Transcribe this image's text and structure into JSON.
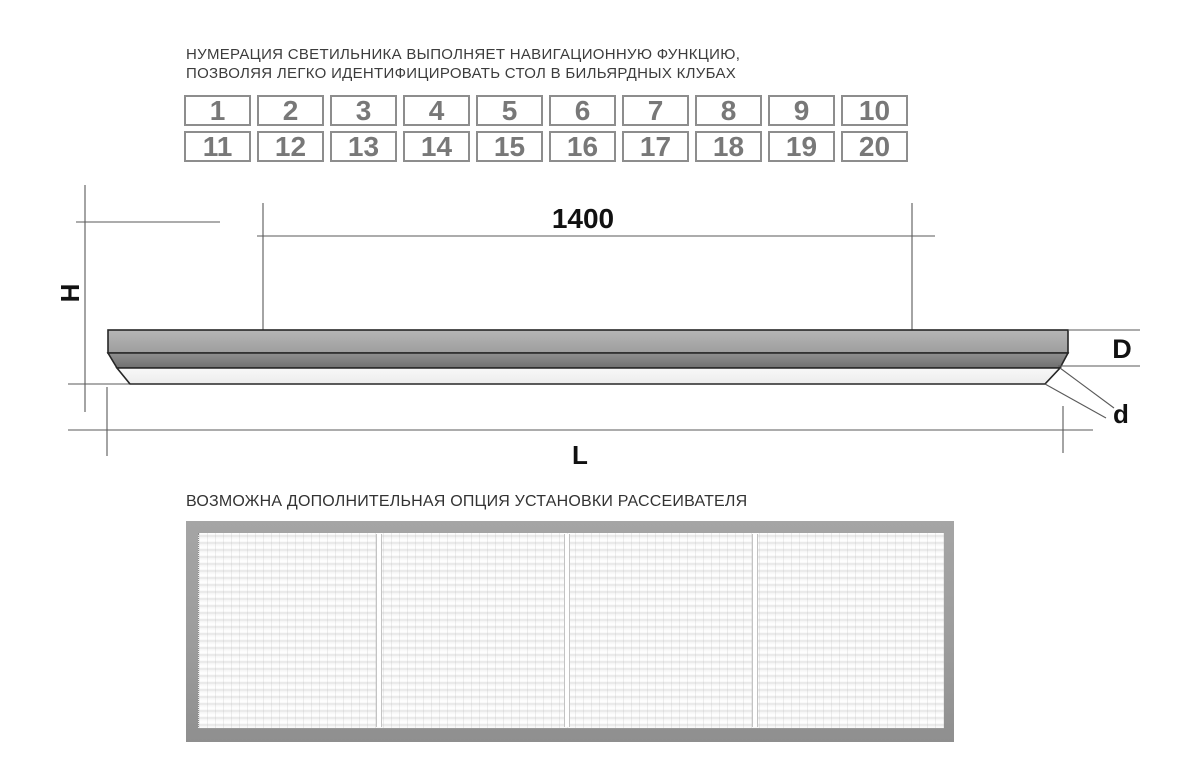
{
  "headline": {
    "line1": "НУМЕРАЦИЯ СВЕТИЛЬНИКА ВЫПОЛНЯЕТ НАВИГАЦИОННУЮ ФУНКЦИЮ,",
    "line2": "ПОЗВОЛЯЯ ЛЕГКО ИДЕНТИФИЦИРОВАТЬ СТОЛ В БИЛЬЯРДНЫХ КЛУБАХ"
  },
  "number_grid": {
    "rows": [
      [
        "1",
        "2",
        "3",
        "4",
        "5",
        "6",
        "7",
        "8",
        "9",
        "10"
      ],
      [
        "11",
        "12",
        "13",
        "14",
        "15",
        "16",
        "17",
        "18",
        "19",
        "20"
      ]
    ]
  },
  "diagram": {
    "dim_span": "1400",
    "dim_height": "H",
    "dim_body": "D",
    "dim_edge": "d",
    "dim_length": "L"
  },
  "caption": "ВОЗМОЖНА ДОПОЛНИТЕЛЬНАЯ ОПЦИЯ УСТАНОВКИ РАССЕИВАТЕЛЯ",
  "colors": {
    "text": "#3c3c3c",
    "drawing_line": "#5a5a5a",
    "fixture_outline": "#262626",
    "fixture_top": "#a9a9a9",
    "fixture_mid": "#828282",
    "fixture_diffuser": "#f4f4f4",
    "box_border": "#8d8d8d",
    "box_number": "#787878",
    "photo_frame": "#9c9c9c"
  }
}
